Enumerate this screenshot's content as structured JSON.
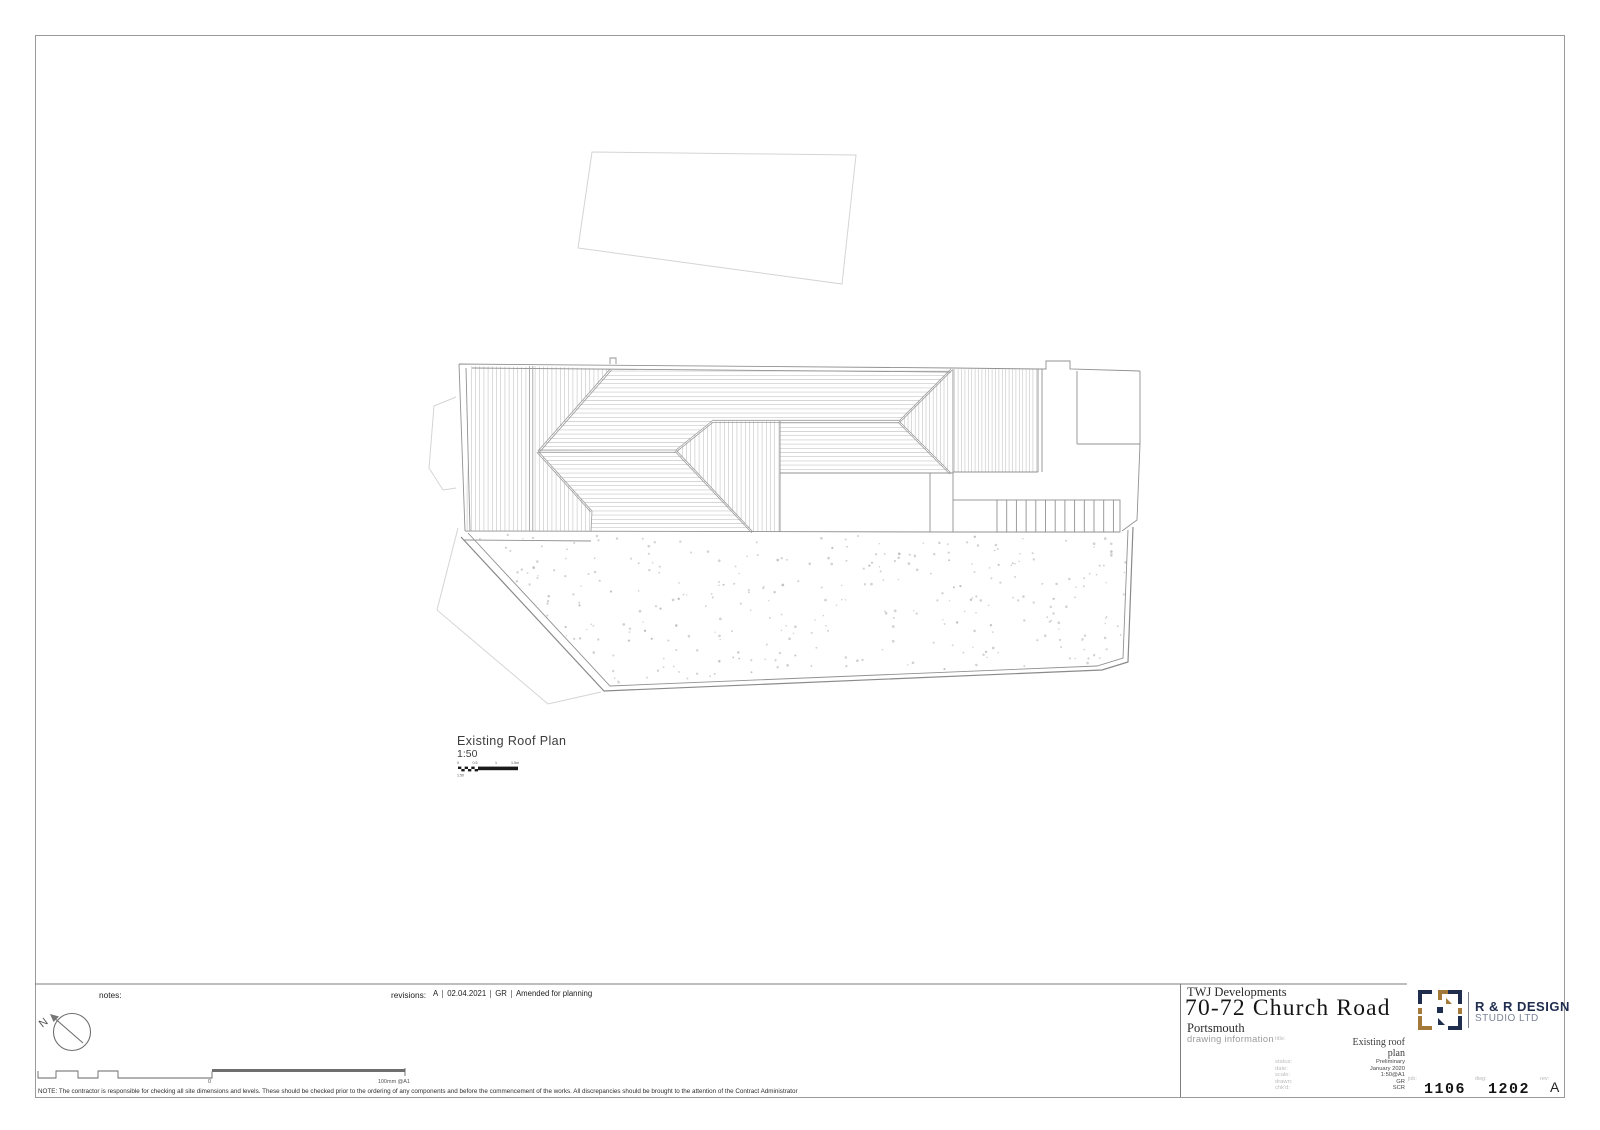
{
  "drawing": {
    "title": "Existing Roof Plan",
    "scale": "1:50",
    "scalebar": {
      "ticks": [
        "0",
        "0.5",
        "1",
        "1.5m"
      ],
      "caption": "1:50"
    }
  },
  "notes": {
    "label": "notes:"
  },
  "revisions": {
    "label": "revisions:",
    "entries": [
      {
        "rev": "A",
        "date": "02.04.2021",
        "by": "GR",
        "desc": "Amended for planning"
      }
    ]
  },
  "north": {
    "label": "N"
  },
  "calibration": {
    "zero": "0",
    "caption": "100mm @A1"
  },
  "footnote": "NOTE: The contractor is responsible for checking all site dimensions and levels. These should be checked prior to the ordering of any components and before the commencement of the works. All discrepancies should be brought to the attention of the Contract Administrator",
  "titleblock": {
    "client": "TWJ Developments",
    "project": "70-72 Church Road",
    "location": "Portsmouth",
    "section_label": "drawing information",
    "fields": [
      {
        "label": "title:",
        "value": "Existing roof plan"
      },
      {
        "label": "status:",
        "value": "Preliminary"
      },
      {
        "label": "date:",
        "value": "January 2020"
      },
      {
        "label": "scale:",
        "value": "1:50@A1"
      },
      {
        "label": "drawn:",
        "value": "GR"
      },
      {
        "label": "chk'd:",
        "value": "SCR"
      }
    ],
    "ids": [
      {
        "label": "job:",
        "value": "1106"
      },
      {
        "label": "dwg:",
        "value": "1202"
      },
      {
        "label": "rev:",
        "value": "A"
      }
    ],
    "logo": {
      "line1": "R & R DESIGN",
      "line2": "STUDIO LTD",
      "navy": "#1f2d4e",
      "gold": "#a3793a",
      "divider": "#7a8396"
    }
  }
}
